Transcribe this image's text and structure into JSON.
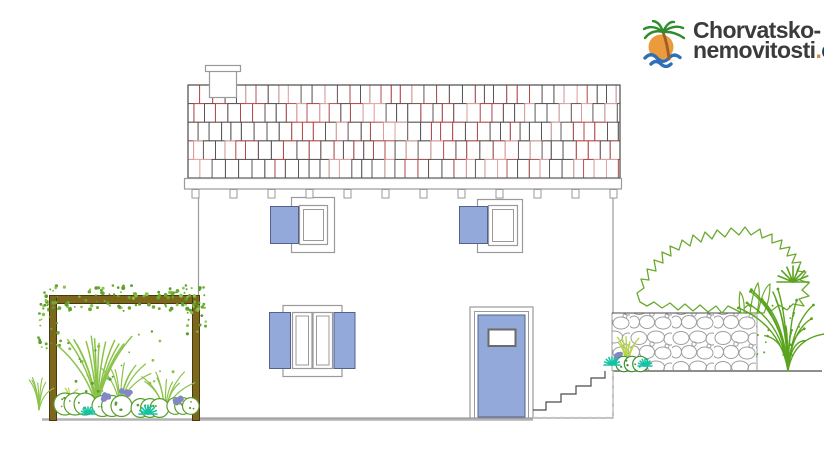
{
  "logo": {
    "brand_line1": "Chorvatsko-",
    "brand_line2": "nemovitosti",
    "brand_dot": ".",
    "brand_tld": "cz",
    "icon": "palm-tree-sun-waves",
    "colors": {
      "text": "#3b3b3b",
      "tld": "#223a5e",
      "dot": "#cf8b3f",
      "sun": "#eb9a3c",
      "palm": "#2e8b2e",
      "trunk": "#9a5f2a",
      "wave": "#2f6fb5"
    }
  },
  "drawing": {
    "type": "house-front-elevation",
    "colors": {
      "outline": "#9a9a9a",
      "dark_line": "#4a4a4a",
      "tile_dark": "#555555",
      "tile_red": "#b5484a",
      "tile_pink": "#e2a4a4",
      "joinery_blue": "#93a9d9",
      "joinery_border": "#55618c",
      "pergola_fill": "#7d671c",
      "pergola_border": "#463a0e",
      "stone": "#9a9a9a",
      "ground": "#b3b3b3",
      "canopy_green": "#6aaa2f",
      "stem_green": "#8bc34a",
      "leaf_green": "#5a9e2e",
      "grass_green": "#5aa31e",
      "tuft_yellow_green": "#b6d44a",
      "teal": "#12c4a4",
      "purple": "#8287c5"
    },
    "features": {
      "upper_windows": 2,
      "lower_window_panels": 2,
      "shutters": "open blue shutters",
      "door": "blue entry door with glass panel",
      "stairs_steps": 5,
      "chimney": 1,
      "pergola": "garden pergola with climbing plants",
      "stone_wall": "rubble stone retaining wall"
    }
  }
}
